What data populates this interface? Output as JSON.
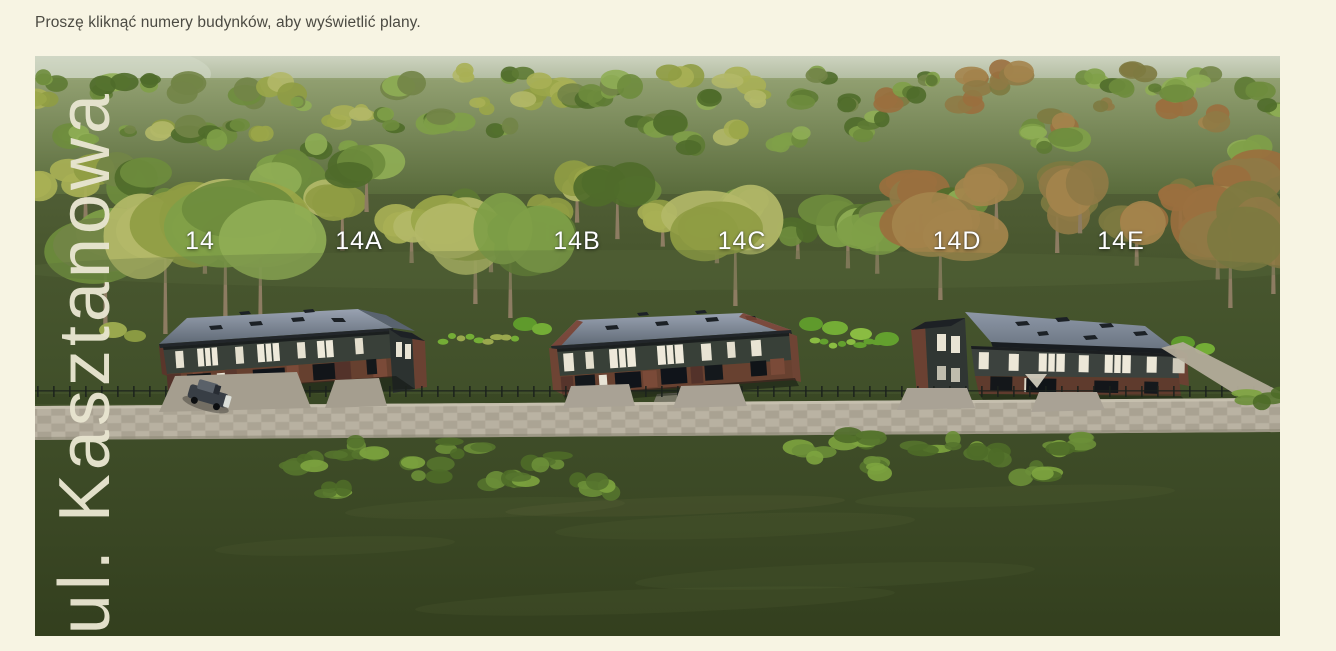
{
  "page": {
    "background_color": "#f7f4e3",
    "instruction": "Proszę kliknąć numery budynków, aby wyświetlić plany."
  },
  "scene": {
    "street_label": "ul. Kasztanowa",
    "street_label_color": "#e8e5d0",
    "building_label_color": "#ffffff",
    "building_labels": [
      "14",
      "14A",
      "14B",
      "14C",
      "14D",
      "14E"
    ],
    "colors": {
      "grass": "#44522b",
      "roof": "#6e7885",
      "facade": "#394039",
      "brick": "#6b4133",
      "road": "#b2ab9b"
    }
  }
}
